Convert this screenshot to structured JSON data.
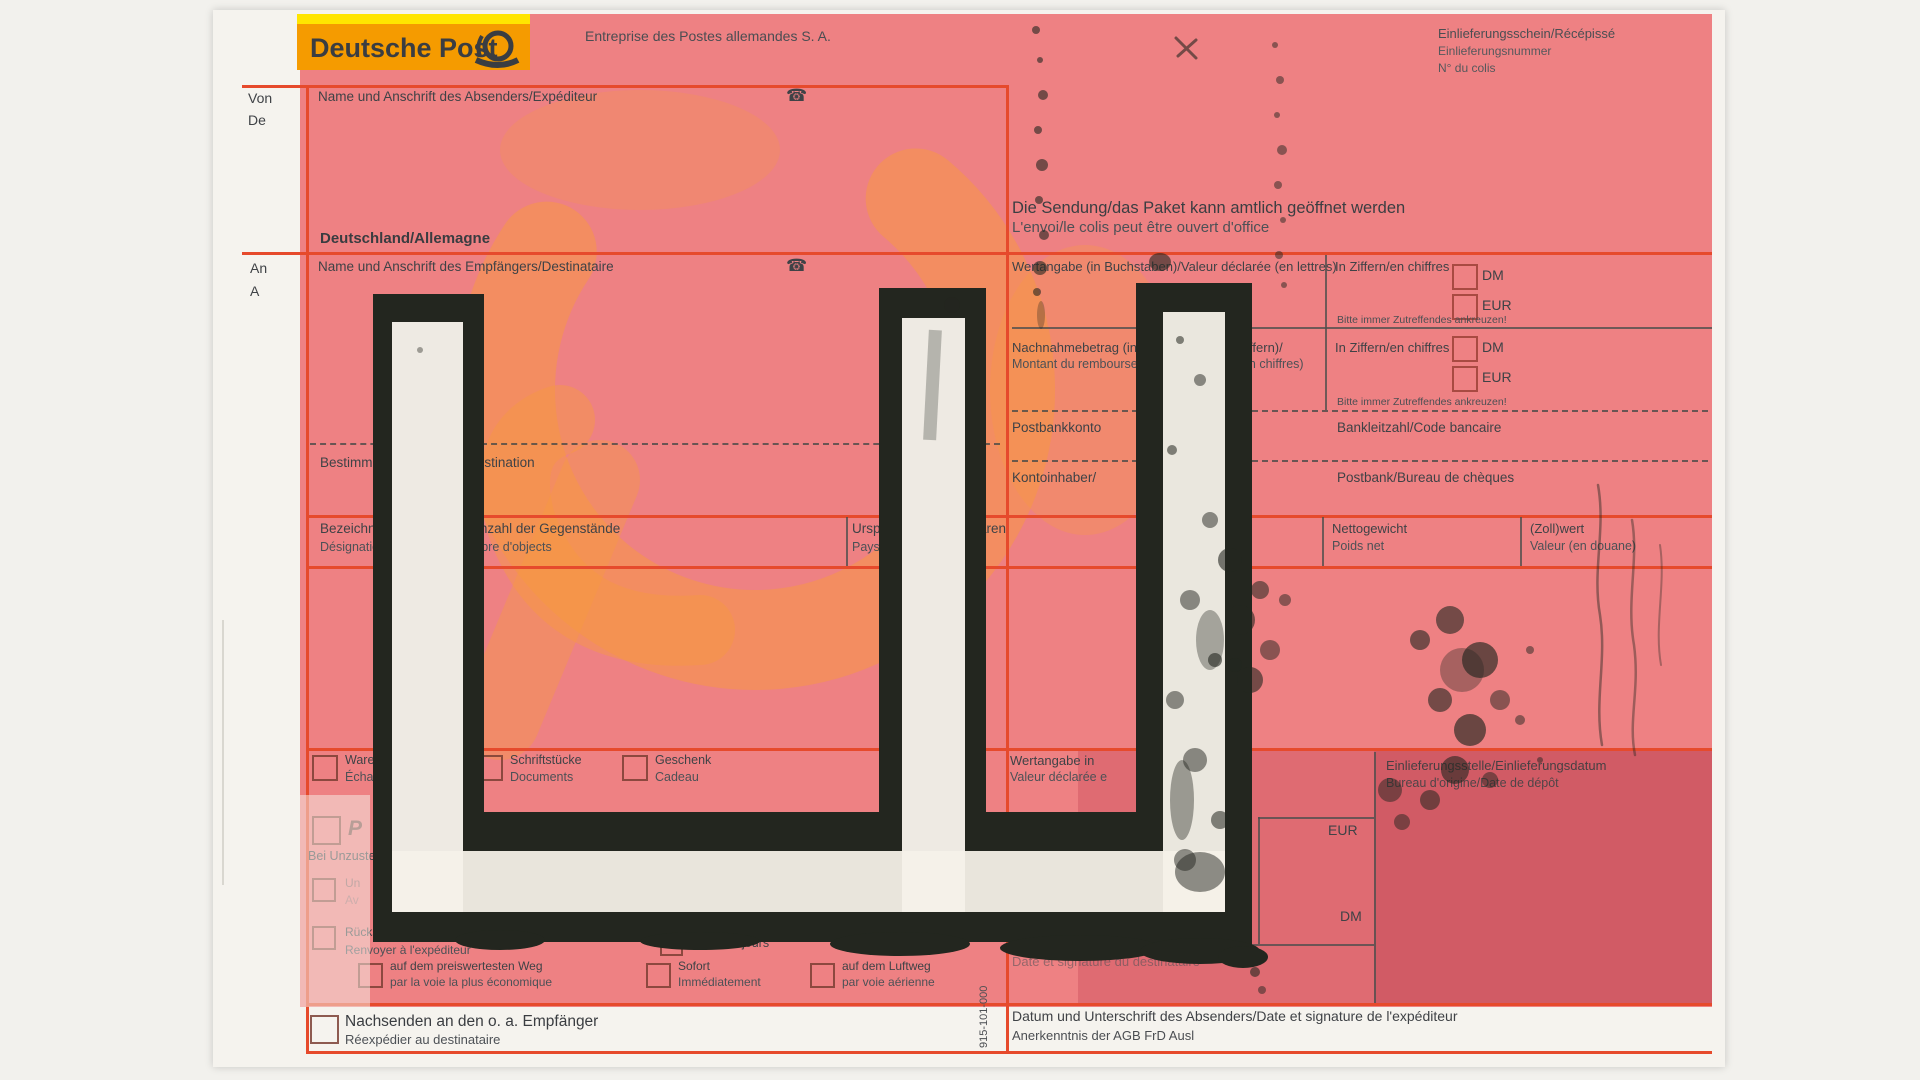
{
  "colors": {
    "accent_red": "#e64a2c",
    "form_pink": "#ee8183",
    "logo_orange": "#f59b00",
    "logo_yellow": "#ffe500",
    "paint_black": "#23261f",
    "paper": "#f5f3ee",
    "watermark_orange": "#f79a40"
  },
  "icons": {
    "phone": "☎",
    "posthorn": "posthorn-icon"
  },
  "logo": {
    "brand": "Deutsche Post",
    "company": "Entreprise des Postes allemandes S. A."
  },
  "receipt": {
    "line1": "Einlieferungsschein/Récépissé",
    "line2": "Einlieferungsnummer",
    "line3": "N° du colis"
  },
  "sender": {
    "von": "Von",
    "de": "De",
    "label": "Name und Anschrift des Absenders/Expéditeur",
    "country": "Deutschland/Allemagne"
  },
  "recipient": {
    "an": "An",
    "a": "A",
    "label": "Name und Anschrift des Empfängers/Destinataire"
  },
  "notice": {
    "de": "Die Sendung/das Paket kann amtlich geöffnet werden",
    "fr": "L'envoi/le colis peut être ouvert d'office"
  },
  "value_row": {
    "label": "Wertangabe (in Buchstaben)/Valeur déclarée (en lettres)",
    "in_ziffern": "In Ziffern/en chiffres",
    "dm": "DM",
    "eur": "EUR",
    "hint": "Bitte immer Zutreffendes ankreuzen!"
  },
  "cod_row": {
    "label_de": "Nachnahmebetrag (in Buchstaben und Ziffern)/",
    "label_fr": "Montant du remboursement (en lettres et en chiffres)",
    "in_ziffern": "In Ziffern/en chiffres",
    "dm": "DM",
    "eur": "EUR",
    "hint": "Bitte immer Zutreffendes ankreuzen!"
  },
  "bank_row": {
    "konto": "Postbankkonto",
    "blz": "Bankleitzahl/Code bancaire",
    "inhaber": "Kontoinhaber/",
    "postbank": "Postbank/Bureau de chèques"
  },
  "dest_row": {
    "label": "Bestimmungsort/Lieu de destination"
  },
  "customs": {
    "content_de": "Bezeichnung des Inhalts/Anzahl der Gegenstände",
    "content_fr": "Désignation du contenu/Nombre d'objects",
    "origin_de": "Ursprungsland der Waren",
    "origin_fr": "Pays d'origine",
    "net_de": "Nettogewicht",
    "net_fr": "Poids net",
    "value_de": "(Zoll)wert",
    "value_fr": "Valeur (en douane)"
  },
  "bottom": {
    "opt_sample": {
      "de": "Warenmuster",
      "fr": "Échantillon"
    },
    "opt_docs": {
      "de": "Schriftstücke",
      "fr": "Documents"
    },
    "opt_gift": {
      "de": "Geschenk",
      "fr": "Cadeau"
    },
    "value_decl": {
      "de": "Wertangabe in",
      "fr": "Valeur déclarée e"
    },
    "office": {
      "de": "Einlieferungsstelle/Einlieferungsdatum",
      "fr": "Bureau d'origine/Date de dépôt"
    },
    "eur": "EUR",
    "dm": "DM",
    "p_option": "P",
    "undeliverable": "Bei Unzustellbarkeit",
    "opt_notify": {
      "de": "Un",
      "fr": "Av"
    },
    "opt_return": {
      "de": "Rücksenden",
      "fr": "Renvoyer à l'expéditeur"
    },
    "after": "Après",
    "days": "jours",
    "opt_cheapest": {
      "de": "auf dem preiswertesten Weg",
      "fr": "par la voie la plus économique"
    },
    "opt_immediate": {
      "de": "Sofort",
      "fr": "Immédiatement"
    },
    "opt_air": {
      "de": "auf dem Luftweg",
      "fr": "par voie aérienne"
    },
    "opt_forward": {
      "de": "Nachsenden an den o. a. Empfänger",
      "fr": "Réexpédier au destinataire"
    },
    "dest_sign": "Date et signature du destinataire"
  },
  "footer": {
    "sign_label": "Datum und Unterschrift des Absenders/Date et signature de l'expéditeur",
    "agb": "Anerkenntnis der AGB FrD Ausl",
    "form_number": "915-101-000"
  }
}
